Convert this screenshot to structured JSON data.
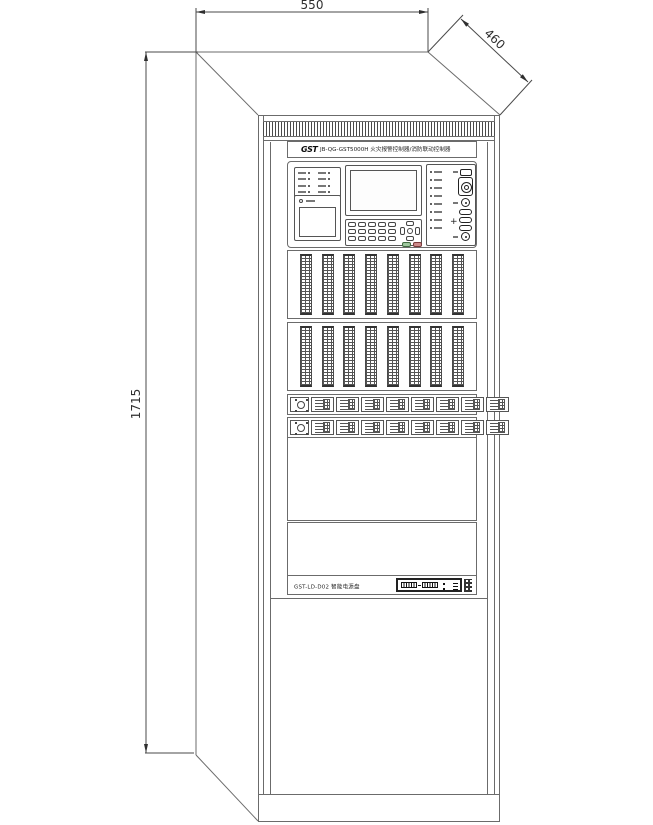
{
  "drawing": {
    "dimensions": {
      "width": "550",
      "depth": "460",
      "height": "1715"
    }
  },
  "cabinet": {
    "header": {
      "logo": "GST",
      "title": "JB-QG-GST5000H 火灾报警控制器/消防联动控制器"
    },
    "control": {
      "plus_label": "+"
    },
    "power_panel": {
      "label": "GST-LD-D02 智能电源盘"
    },
    "structure": {
      "loop_module_rows": 2,
      "loop_modules_per_row": 8,
      "io_module_rows": 2,
      "io_modules_per_row": 8,
      "left_indicators": 8,
      "right_indicators": 8,
      "keypad_keys": 15
    },
    "colors": {
      "line": "#6b6b6b",
      "dark": "#2f2f2f",
      "green_key": "#9ec79e",
      "red_key": "#cc8a8a"
    }
  }
}
